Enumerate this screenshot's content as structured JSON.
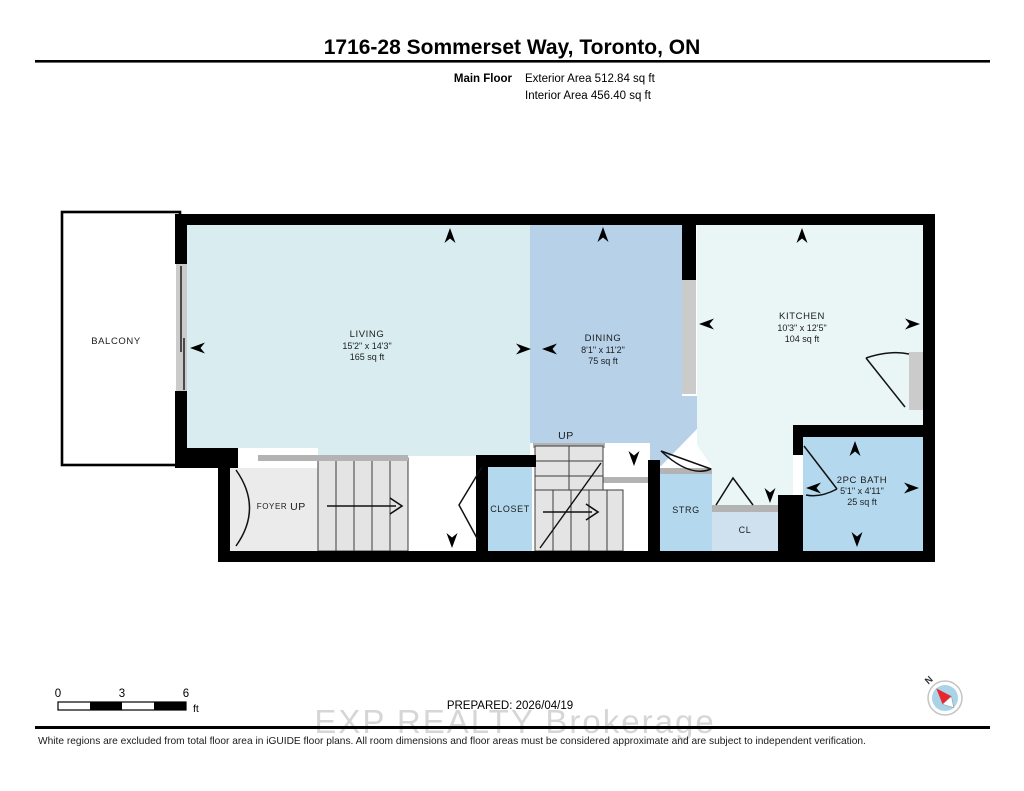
{
  "header": {
    "title": "1716-28 Sommerset Way, Toronto, ON",
    "floor_label": "Main Floor",
    "exterior_area": "Exterior Area 512.84 sq ft",
    "interior_area": "Interior Area 456.40 sq ft"
  },
  "rooms": {
    "balcony": {
      "name": "BALCONY"
    },
    "living": {
      "name": "LIVING",
      "dims": "15'2\" x 14'3\"",
      "area": "165 sq ft"
    },
    "dining": {
      "name": "DINING",
      "dims": "8'1\" x 11'2\"",
      "area": "75 sq ft"
    },
    "kitchen": {
      "name": "KITCHEN",
      "dims": "10'3\" x 12'5\"",
      "area": "104 sq ft"
    },
    "bath": {
      "name": "2PC BATH",
      "dims": "5'1\" x 4'11\"",
      "area": "25 sq ft"
    },
    "foyer": {
      "name": "FOYER",
      "up": "UP"
    },
    "stairs_up": {
      "label": "UP"
    },
    "closet": {
      "name": "CLOSET"
    },
    "strg": {
      "name": "STRG"
    },
    "cl": {
      "name": "CL"
    }
  },
  "scale_bar": {
    "tick0": "0",
    "tick1": "3",
    "tick2": "6",
    "unit": "ft"
  },
  "compass": {
    "north_label": "N"
  },
  "footer": {
    "prepared": "PREPARED: 2026/04/19",
    "watermark": "EXP REALTY  Brokerage",
    "disclaimer": "White regions are excluded from total floor area in iGUIDE floor plans. All room dimensions and floor areas must be considered approximate and are subject to independent verification."
  },
  "colors": {
    "living": "#d9edf0",
    "dining": "#b7d2e8",
    "kitchen": "#eaf5f6",
    "small_room": "#b4d9ef",
    "cl_room": "#cfe0ee",
    "wall": "#000000",
    "door_gray": "#cbcbcb",
    "sill_gray": "#b3b3b3",
    "stair_fill": "#e4e4e4",
    "foyer_fill": "#ebebeb",
    "compass_face": "#a9d4e7",
    "needle_red": "#e8262d"
  }
}
